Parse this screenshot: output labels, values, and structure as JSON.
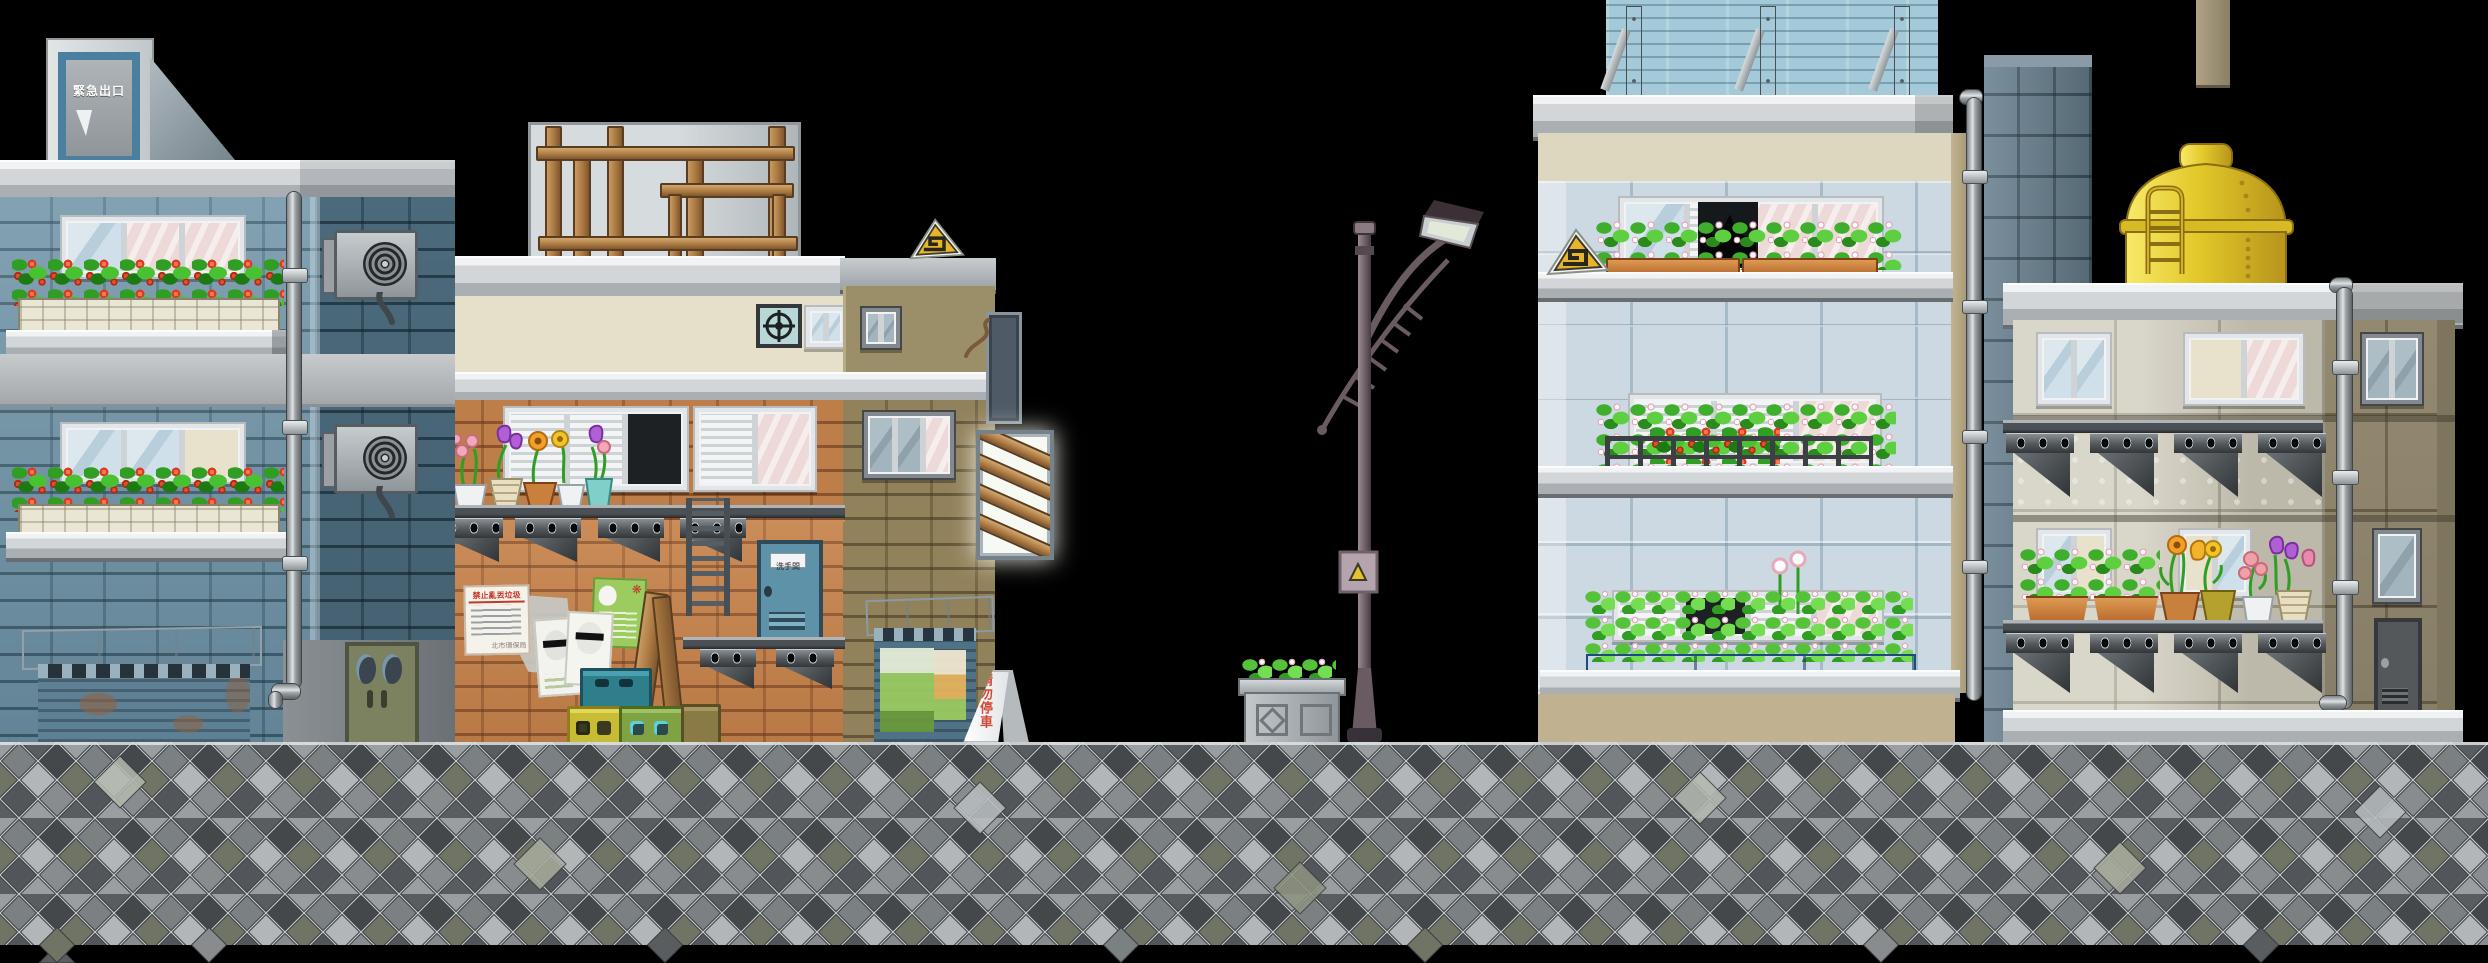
{
  "scene": {
    "type": "pixel-art side-scroller street background",
    "width": 2488,
    "height": 963,
    "background_color": "#000000",
    "description": "Row of apartment buildings behind a diamond-mosaic stone wall, with a street lamp, bush planter, water tank and rooftop props"
  },
  "signs": {
    "emergency_exit": "緊急出口",
    "restroom": "洗手間",
    "no_littering_title": "禁止亂丟垃圾",
    "no_littering_stamp": "北市環保局",
    "no_parking": "請勿停車"
  },
  "buildings": {
    "left_blue": {
      "name": "blue brick apartment",
      "features": [
        "rooftop emergency-exit hut",
        "two flower-box windows with red flowers",
        "rusty roller shutter with awning",
        "olive double door",
        "drain pipe",
        "two wall AC fan units"
      ]
    },
    "middle_cream": {
      "name": "cream and brick shop-house",
      "features": [
        "rooftop wooden scaffold",
        "vent fan",
        "flower pots on bracket shelf",
        "posters",
        "chain ladder",
        "restroom door",
        "stacked bottle crates",
        "leaning planks",
        "shutter with posters",
        "A-frame no-parking sign",
        "yellow triangle sign",
        "backlit slat sign"
      ]
    },
    "right_tiled": {
      "name": "light-blue tiled apartment block",
      "features": [
        "rooftop plank billboard with struts",
        "three planter floors (clover, strawberries, white flowers)",
        "black cat in broken window",
        "yellow triangle sign",
        "drain pipe"
      ]
    },
    "far_right": {
      "name": "gray panel apartment",
      "features": [
        "yellow rooftop water tank with ladder",
        "two bracket-shelf balcony rows",
        "flower pots (clover, orange, pink, purple)",
        "metal service door",
        "drain pipe",
        "rooftop chimney block"
      ]
    }
  },
  "objects": [
    "street-lamp",
    "lamp-junction-box",
    "stone-bush-planter",
    "stone-mosaic-wall"
  ],
  "palette": {
    "brick_blue": "#6E93A7",
    "brick_tan": "#BD7E49",
    "tile_blue": "#CCD8E2",
    "panel_gray": "#CCC8B8",
    "panel_khaki": "#A0957A",
    "tank_yellow": "#E8CF35",
    "foliage_green": "#49C231",
    "flower_red": "#E84A2E",
    "sign_red": "#D44A3A",
    "crate_teal": "#2E7E8C",
    "crate_yellow": "#C9BC35",
    "crate_green": "#7FA342",
    "door_teal": "#5D92A8",
    "wall_gray": "#8E9294",
    "concrete": "#D2D6D9"
  }
}
